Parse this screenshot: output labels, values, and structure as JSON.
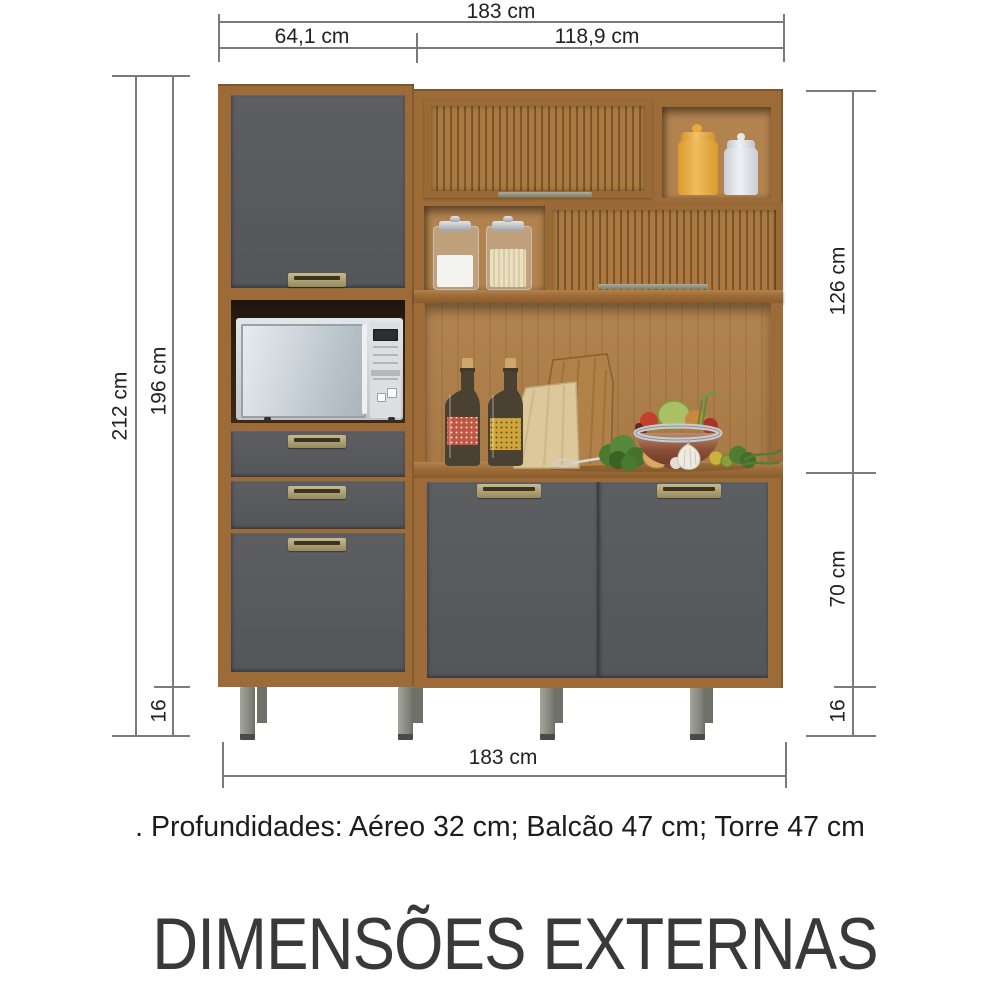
{
  "title": "DIMENSÕES EXTERNAS",
  "note": ". Profundidades: Aéreo 32 cm; Balcão 47 cm; Torre 47 cm",
  "dims": {
    "total_width_top": "183 cm",
    "tower_width": "64,1 cm",
    "hutch_width": "118,9 cm",
    "total_height": "212 cm",
    "body_height": "196 cm",
    "feet_left": "16",
    "hutch_height": "126 cm",
    "base_height": "70 cm",
    "feet_right": "16",
    "total_width_bottom": "183 cm"
  },
  "colors": {
    "wood": "#9c6b37",
    "wood-dark": "#7c5526",
    "wood-light": "#b2834f",
    "counter": "#9e6d38",
    "door-gray": "#57585a",
    "handle-bronze": "#b3a678",
    "feet-metal": "#8f9089",
    "line": "#7a7a7a",
    "text": "#222222",
    "title": "#3a383c"
  }
}
